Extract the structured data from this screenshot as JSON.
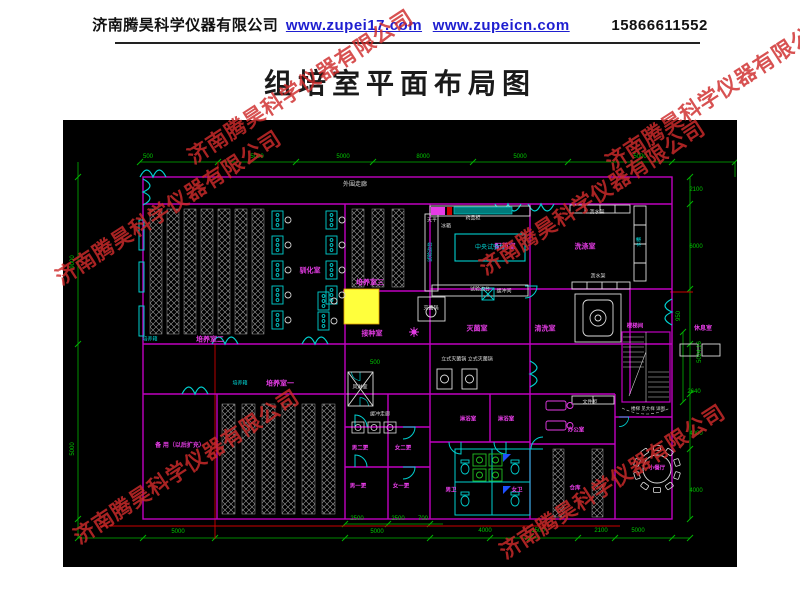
{
  "header": {
    "company": "济南腾昊科学仪器有限公司",
    "url1": "www.zupei17.com",
    "url2": "www.zupeicn.com",
    "phone": "15866611552"
  },
  "title": "组培室平面布局图",
  "watermark": {
    "text": "济南腾昊科学仪器有限公司",
    "color": "#cf2b2b",
    "positions": [
      {
        "x": 300,
        "y": 86
      },
      {
        "x": 718,
        "y": 92
      },
      {
        "x": 168,
        "y": 207
      },
      {
        "x": 592,
        "y": 197
      },
      {
        "x": 186,
        "y": 466
      },
      {
        "x": 612,
        "y": 481
      }
    ]
  },
  "colors": {
    "background": "#000000",
    "wall": "#c000c0",
    "dimension": "#00b400",
    "door_window": "#00d0d0",
    "room_label": "#e63ce6",
    "equipment_label": "#dcdcdc",
    "highlight_box": "#ffff3c",
    "construction_line": "#cc0000"
  },
  "plan": {
    "room_labels": [
      {
        "t": "外围走廊",
        "x": 292,
        "y": 65,
        "k": "w"
      },
      {
        "t": "驯化室",
        "x": 247,
        "y": 151,
        "k": "m"
      },
      {
        "t": "培养室三",
        "x": 307,
        "y": 163,
        "k": "m"
      },
      {
        "t": "接种室",
        "x": 309,
        "y": 214,
        "k": "m"
      },
      {
        "t": "培养室二",
        "x": 147,
        "y": 220,
        "k": "m"
      },
      {
        "t": "培养室一",
        "x": 217,
        "y": 264,
        "k": "m"
      },
      {
        "t": "配药室",
        "x": 442,
        "y": 127,
        "k": "m"
      },
      {
        "t": "洗涤室",
        "x": 522,
        "y": 127,
        "k": "m"
      },
      {
        "t": "灭菌室",
        "x": 414,
        "y": 209,
        "k": "m"
      },
      {
        "t": "清洗室",
        "x": 482,
        "y": 209,
        "k": "m"
      },
      {
        "t": "休息室",
        "x": 640,
        "y": 209,
        "k": "m",
        "fs": 6
      },
      {
        "t": "楼梯间",
        "x": 572,
        "y": 207,
        "k": "m",
        "fs": 5.5
      },
      {
        "t": "淋浴室",
        "x": 405,
        "y": 300,
        "k": "m",
        "fs": 5.5
      },
      {
        "t": "淋浴室",
        "x": 443,
        "y": 300,
        "k": "m",
        "fs": 5.5
      },
      {
        "t": "男卫",
        "x": 388,
        "y": 371,
        "k": "m",
        "fs": 5.5
      },
      {
        "t": "女卫",
        "x": 454,
        "y": 371,
        "k": "m",
        "fs": 5.5
      },
      {
        "t": "办公室",
        "x": 513,
        "y": 311,
        "k": "m",
        "fs": 5.5
      },
      {
        "t": "仓库",
        "x": 512,
        "y": 369,
        "k": "m",
        "fs": 5.5
      },
      {
        "t": "小餐厅",
        "x": 594,
        "y": 349,
        "k": "m",
        "fs": 5.5
      },
      {
        "t": "男二更",
        "x": 297,
        "y": 329,
        "k": "m",
        "fs": 5.5
      },
      {
        "t": "女二更",
        "x": 340,
        "y": 329,
        "k": "m",
        "fs": 5.5
      },
      {
        "t": "男一更",
        "x": 295,
        "y": 367,
        "k": "m",
        "fs": 5.5
      },
      {
        "t": "女一更",
        "x": 338,
        "y": 367,
        "k": "m",
        "fs": 5.5
      },
      {
        "t": "备 用（以后扩充）",
        "x": 117,
        "y": 326,
        "k": "m",
        "fs": 6
      }
    ],
    "equipment_labels": [
      {
        "t": "天平",
        "x": 369,
        "y": 101,
        "k": "w",
        "fs": 5
      },
      {
        "t": "冰箱",
        "x": 383,
        "y": 107,
        "k": "w",
        "fs": 5
      },
      {
        "t": "药品柜",
        "x": 410,
        "y": 99,
        "k": "w",
        "fs": 5
      },
      {
        "t": "沥水架",
        "x": 534,
        "y": 93,
        "k": "w",
        "fs": 5
      },
      {
        "t": "沥水架",
        "x": 535,
        "y": 157,
        "k": "w",
        "fs": 5
      },
      {
        "t": "水槽",
        "x": 577,
        "y": 122,
        "k": "c",
        "fs": 5,
        "r": 1
      },
      {
        "t": "试验边台",
        "x": 368,
        "y": 132,
        "k": "c",
        "fs": 5,
        "r": 1
      },
      {
        "t": "中央试验台",
        "x": 427,
        "y": 128,
        "k": "c"
      },
      {
        "t": "灭菌锅",
        "x": 368,
        "y": 189,
        "k": "w",
        "fs": 5
      },
      {
        "t": "试验边台",
        "x": 417,
        "y": 170,
        "k": "w",
        "fs": 5
      },
      {
        "t": "缓冲间",
        "x": 441,
        "y": 172,
        "k": "w",
        "fs": 5
      },
      {
        "t": "立式灭菌锅 立式灭菌锅",
        "x": 404,
        "y": 240,
        "k": "w",
        "fs": 5
      },
      {
        "t": "风淋室",
        "x": 297,
        "y": 268,
        "k": "w",
        "fs": 5
      },
      {
        "t": "缓冲走廊",
        "x": 317,
        "y": 295,
        "k": "w",
        "fs": 5
      },
      {
        "t": "文件柜",
        "x": 527,
        "y": 283,
        "k": "w",
        "fs": 5
      },
      {
        "t": "楼梯 见大样 详图",
        "x": 585,
        "y": 289,
        "k": "w",
        "fs": 4.5
      },
      {
        "t": "培养箱",
        "x": 87,
        "y": 220,
        "k": "c",
        "fs": 5
      },
      {
        "t": "培养箱",
        "x": 177,
        "y": 264,
        "k": "c",
        "fs": 5
      }
    ],
    "dimensions": [
      {
        "t": "500",
        "x": 85,
        "y": 37
      },
      {
        "t": "5000",
        "x": 194,
        "y": 37
      },
      {
        "t": "5000",
        "x": 280,
        "y": 37
      },
      {
        "t": "8000",
        "x": 360,
        "y": 37
      },
      {
        "t": "5000",
        "x": 457,
        "y": 37
      },
      {
        "t": "5000",
        "x": 577,
        "y": 37
      },
      {
        "t": "9000",
        "x": 10,
        "y": 142,
        "r": 1
      },
      {
        "t": "5000",
        "x": 10,
        "y": 329,
        "r": 1
      },
      {
        "t": "2100",
        "x": 633,
        "y": 70
      },
      {
        "t": "6000",
        "x": 633,
        "y": 127
      },
      {
        "t": "950",
        "x": 616,
        "y": 196,
        "r": 1
      },
      {
        "t": "5024.16",
        "x": 637,
        "y": 232,
        "r": 1
      },
      {
        "t": "2640",
        "x": 631,
        "y": 272
      },
      {
        "t": "4000",
        "x": 633,
        "y": 314
      },
      {
        "t": "4000",
        "x": 633,
        "y": 371
      },
      {
        "t": "5000",
        "x": 115,
        "y": 412
      },
      {
        "t": "5000",
        "x": 314,
        "y": 412
      },
      {
        "t": "4000",
        "x": 422,
        "y": 411
      },
      {
        "t": "1500",
        "x": 475,
        "y": 411
      },
      {
        "t": "2100",
        "x": 538,
        "y": 411
      },
      {
        "t": "5000",
        "x": 575,
        "y": 411
      },
      {
        "t": "2500",
        "x": 294,
        "y": 399
      },
      {
        "t": "2500",
        "x": 335,
        "y": 399
      },
      {
        "t": "700",
        "x": 360,
        "y": 399
      },
      {
        "t": "500",
        "x": 312,
        "y": 243
      }
    ]
  }
}
